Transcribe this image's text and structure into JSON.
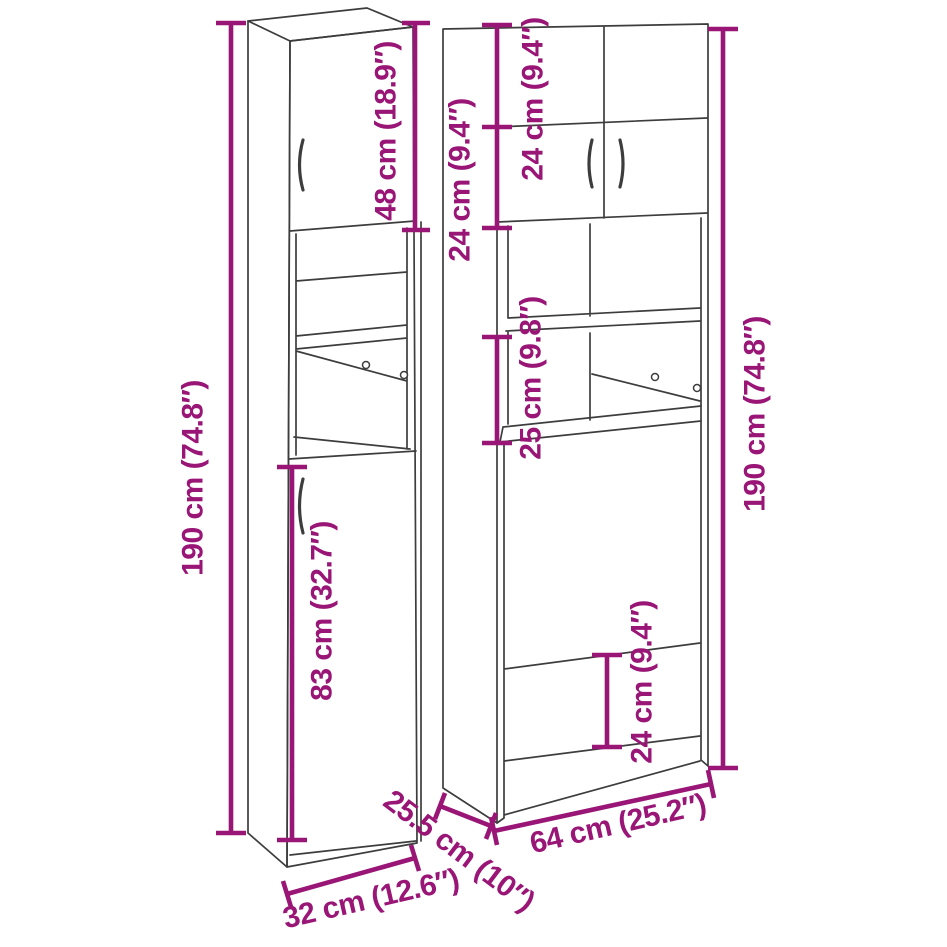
{
  "diagram": {
    "colors": {
      "dimension_annotation": "#991677",
      "cabinet_outline": "#3d3d3d",
      "background": "#ffffff"
    },
    "left_cabinet": {
      "height_label": "190 cm (74.8″)",
      "top_door_height_label": "48 cm (18.9″)",
      "bottom_door_height_label": "83 cm (32.7″)",
      "width_label": "32 cm (12.6″)"
    },
    "shared": {
      "depth_label": "25.5 cm (10″)"
    },
    "right_cabinet": {
      "height_label": "190 cm (74.8″)",
      "top_section_height_label": "24 cm (9.4″)",
      "second_section_height_label": "24 cm (9.4″)",
      "shelf_gap_height_label": "25 cm (9.8″)",
      "base_rail_height_label": "24 cm (9.4″)",
      "width_label": "64 cm (25.2″)"
    }
  }
}
